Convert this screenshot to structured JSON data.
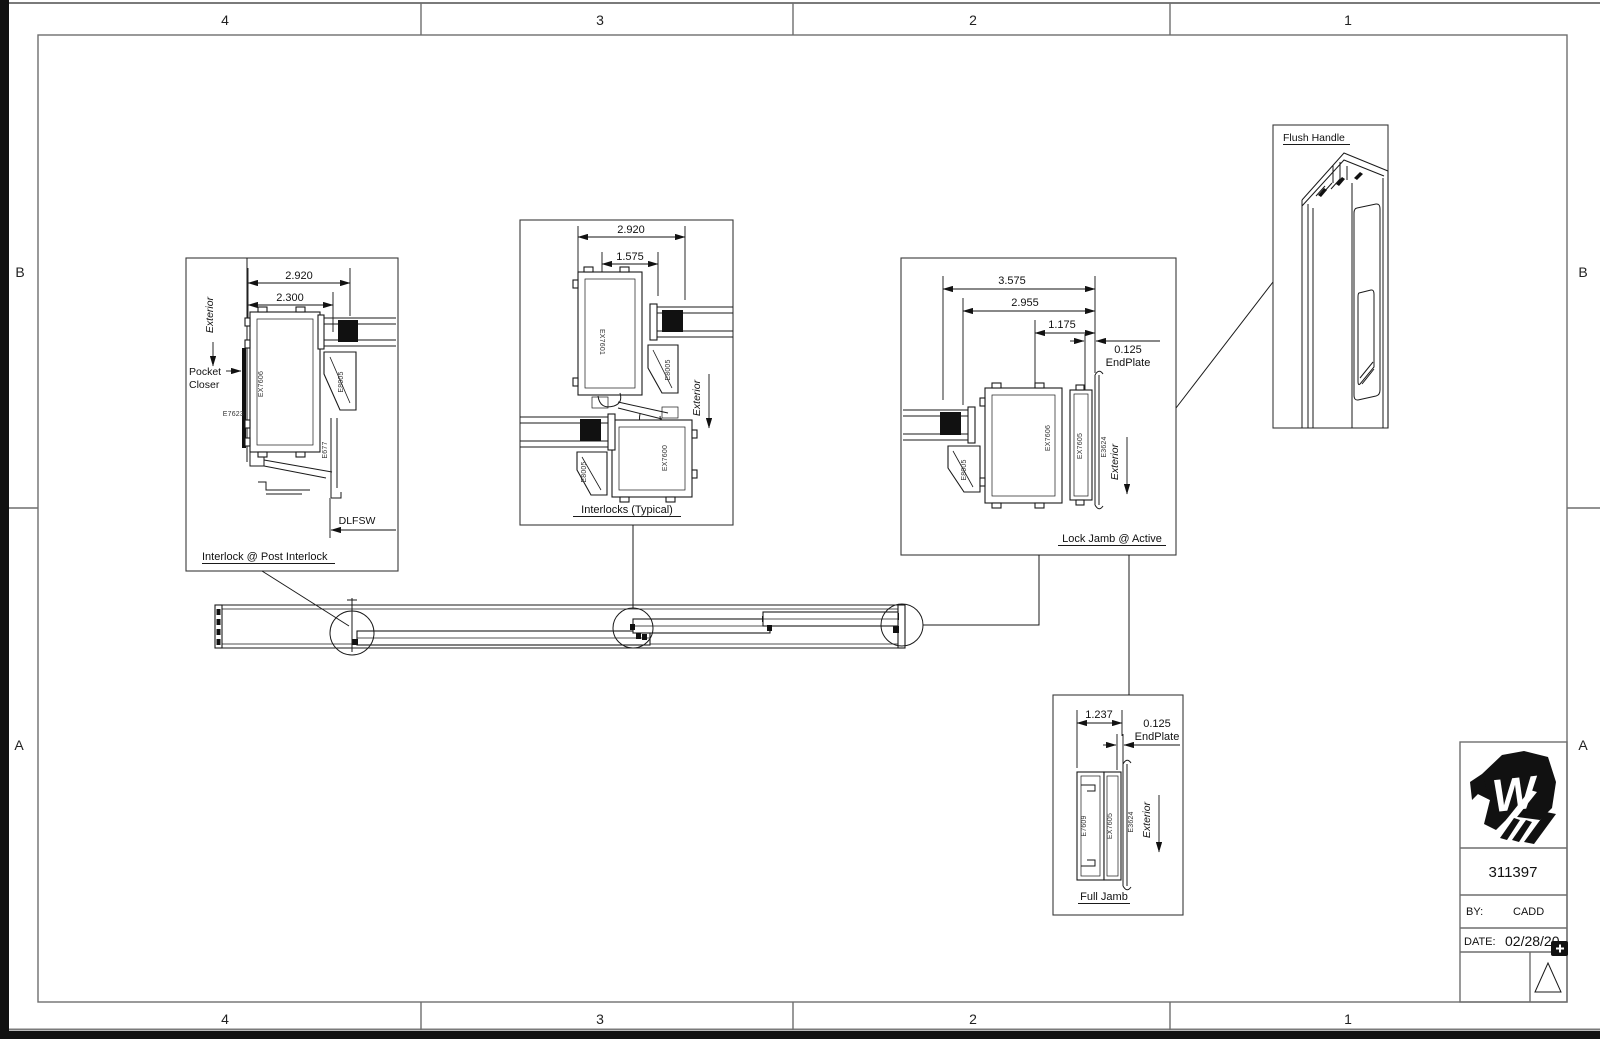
{
  "sheet": {
    "zones": {
      "top": [
        "4",
        "3",
        "2",
        "1"
      ],
      "bottom": [
        "4",
        "3",
        "2",
        "1"
      ],
      "left": [
        "B",
        "A"
      ],
      "right": [
        "B",
        "A"
      ]
    },
    "title_block": {
      "logo_letter": "W",
      "drawing_number": "311397",
      "by_label": "BY:",
      "by_value": "CADD",
      "date_label": "DATE:",
      "date_value": "02/28/20"
    }
  },
  "details": {
    "post_interlock": {
      "title": "Interlock @ Post Interlock",
      "dim_overall": "2.920",
      "dim_inner": "2.300",
      "exterior_label": "Exterior",
      "pocket_closer_line1": "Pocket",
      "pocket_closer_line2": "Closer",
      "part_e7623": "E7623",
      "part_ex7606": "EX7606",
      "part_e8005": "E8005",
      "part_e677": "E677",
      "dlfsw_label": "DLFSW"
    },
    "interlocks_typical": {
      "title": "Interlocks (Typical)",
      "dim_overall": "2.920",
      "dim_inner": "1.575",
      "part_ex7601": "EX7601",
      "part_e8005_top": "E8005",
      "part_ex7600": "EX7600",
      "part_e8005_bottom": "E8005",
      "exterior_label": "Exterior"
    },
    "lock_jamb": {
      "title": "Lock Jamb @ Active",
      "dim_overall": "3.575",
      "dim_mid": "2.955",
      "dim_inner": "1.175",
      "endplate_value": "0.125",
      "endplate_label": "EndPlate",
      "part_e8005": "E8005",
      "part_ex7606": "EX7606",
      "part_ex7605": "EX7605",
      "part_e3624": "E3624",
      "exterior_label": "Exterior"
    },
    "full_jamb": {
      "title": "Full Jamb",
      "dim_overall": "1.237",
      "endplate_value": "0.125",
      "endplate_label": "EndPlate",
      "part_e7609": "E7609",
      "part_ex7605": "EX7605",
      "part_e3624": "E3624",
      "exterior_label": "Exterior"
    },
    "flush_handle": {
      "title": "Flush Handle"
    }
  }
}
